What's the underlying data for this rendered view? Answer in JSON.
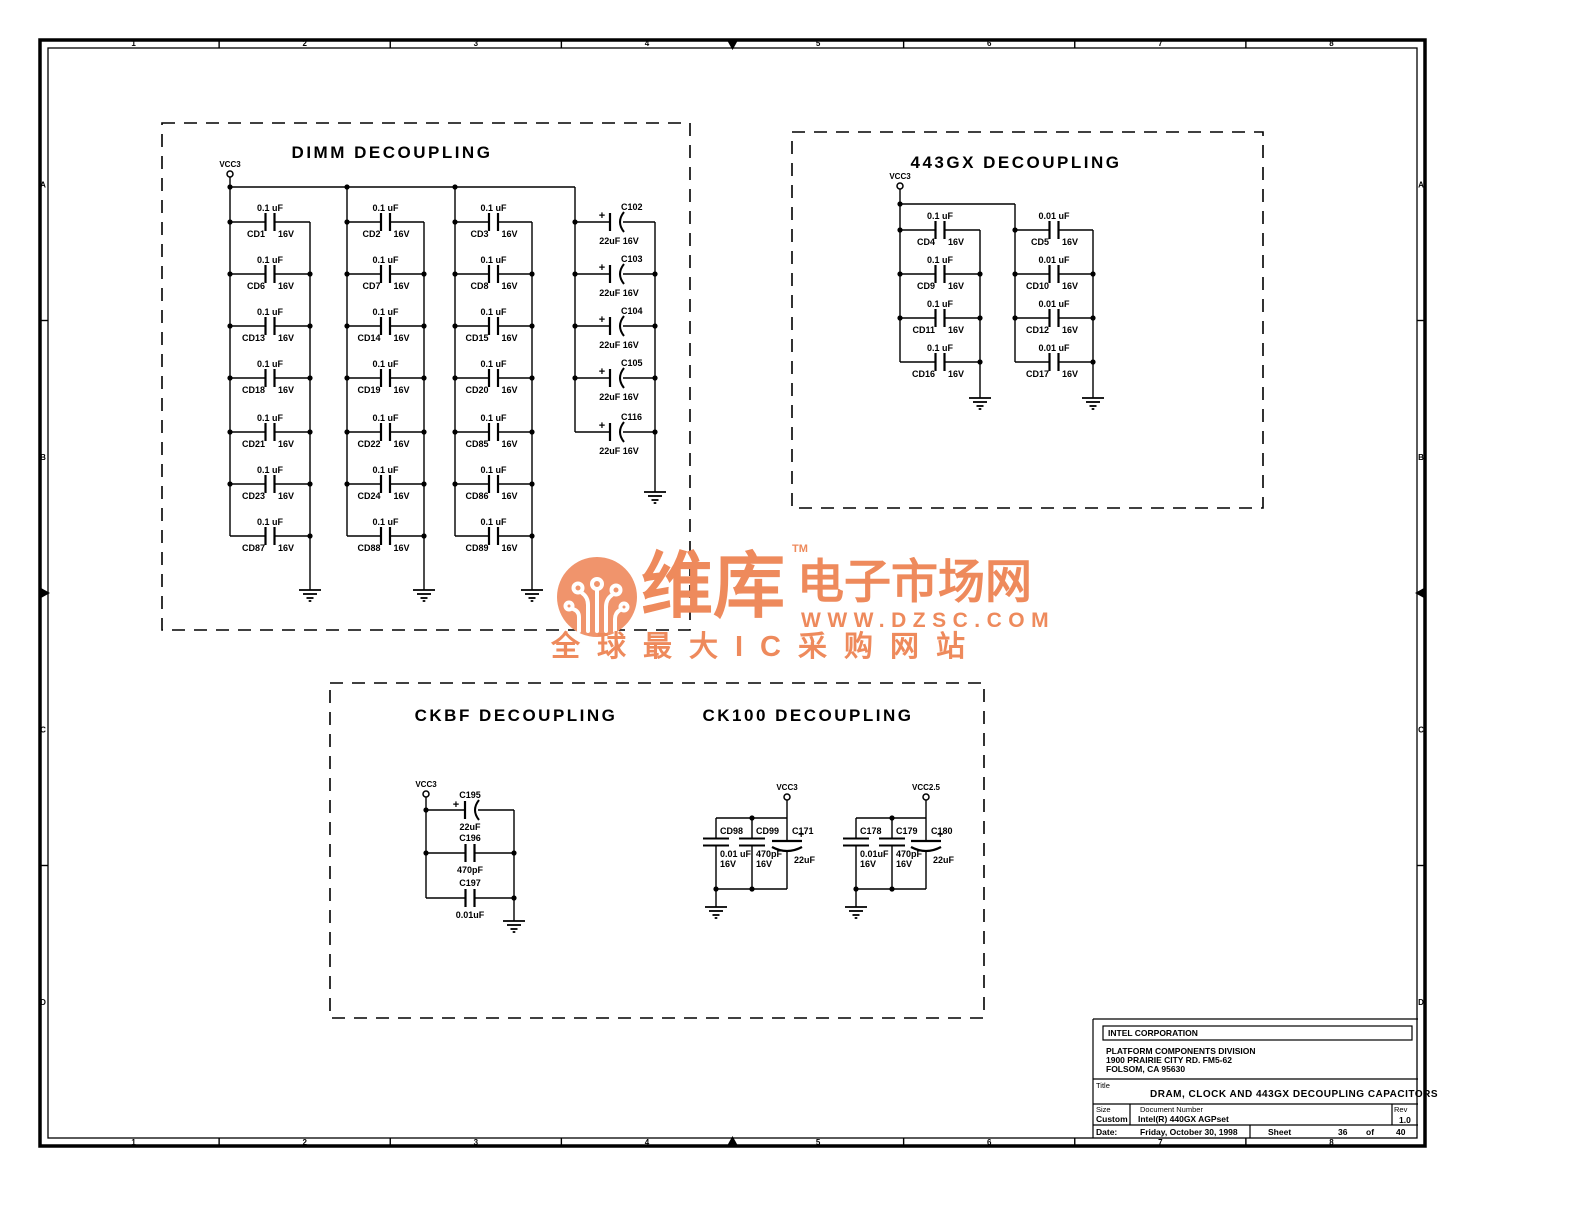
{
  "frame": {
    "cols": [
      "1",
      "2",
      "3",
      "4",
      "5",
      "6",
      "7",
      "8"
    ],
    "rows": [
      "A",
      "B",
      "C",
      "D"
    ]
  },
  "dimm": {
    "title": "DIMM DECOUPLING",
    "power": "VCC3",
    "value": "0.1 uF",
    "volt": "16V",
    "columns": [
      [
        "CD1",
        "CD6",
        "CD13",
        "CD18",
        "CD21",
        "CD23",
        "CD87"
      ],
      [
        "CD2",
        "CD7",
        "CD14",
        "CD19",
        "CD22",
        "CD24",
        "CD88"
      ],
      [
        "CD3",
        "CD8",
        "CD15",
        "CD20",
        "CD85",
        "CD86",
        "CD89"
      ]
    ],
    "bulk": {
      "names": [
        "C102",
        "C103",
        "C104",
        "C105",
        "C116"
      ],
      "value": "22uF 16V",
      "plus": "+"
    }
  },
  "gx": {
    "title": "443GX DECOUPLING",
    "power": "VCC3",
    "columns": [
      {
        "value": "0.1 uF",
        "volt": "16V",
        "names": [
          "CD4",
          "CD9",
          "CD11",
          "CD16"
        ]
      },
      {
        "value": "0.01 uF",
        "volt": "16V",
        "names": [
          "CD5",
          "CD10",
          "CD12",
          "CD17"
        ]
      }
    ]
  },
  "ckbf": {
    "title": "CKBF DECOUPLING",
    "power": "VCC3",
    "plus": "+",
    "caps": [
      {
        "name": "C195",
        "value": "22uF",
        "polar": true
      },
      {
        "name": "C196",
        "value": "470pF",
        "polar": false
      },
      {
        "name": "C197",
        "value": "0.01uF",
        "polar": false
      }
    ]
  },
  "ck100": {
    "title": "CK100 DECOUPLING",
    "plus": "+",
    "groups": [
      {
        "power": "VCC3",
        "caps": [
          {
            "name": "CD98",
            "value": "0.01 uF",
            "volt": "16V",
            "polar": false
          },
          {
            "name": "CD99",
            "value": "470pF",
            "volt": "16V",
            "polar": false
          },
          {
            "name": "C171",
            "value": "22uF",
            "volt": "",
            "polar": true
          }
        ]
      },
      {
        "power": "VCC2.5",
        "caps": [
          {
            "name": "C178",
            "value": "0.01uF",
            "volt": "16V",
            "polar": false
          },
          {
            "name": "C179",
            "value": "470pF",
            "volt": "16V",
            "polar": false
          },
          {
            "name": "C180",
            "value": "22uF",
            "volt": "",
            "polar": true
          }
        ]
      }
    ]
  },
  "title_block": {
    "company": "INTEL CORPORATION",
    "division": "PLATFORM COMPONENTS DIVISION",
    "address1": "1900 PRAIRIE CITY RD. FM5-62",
    "address2": "FOLSOM, CA 95630",
    "title_label": "Title",
    "title": "DRAM, CLOCK AND 443GX DECOUPLING CAPACITORS",
    "size_label": "Size",
    "size": "Custom",
    "doc_label": "Document Number",
    "doc": "Intel(R) 440GX AGPset",
    "rev_label": "Rev",
    "rev": "1.0",
    "date_label": "Date:",
    "date": "Friday, October 30, 1998",
    "sheet_label": "Sheet",
    "sheet_num": "36",
    "of_label": "of",
    "sheet_total": "40"
  },
  "watermark": {
    "brand": "维库",
    "tm": "TM",
    "market": "电子市场网",
    "url": "WWW.DZSC.COM",
    "tagline": "全球最大IC采购网站",
    "orange": "#ee8a5c",
    "salmon": "#f0946c"
  }
}
